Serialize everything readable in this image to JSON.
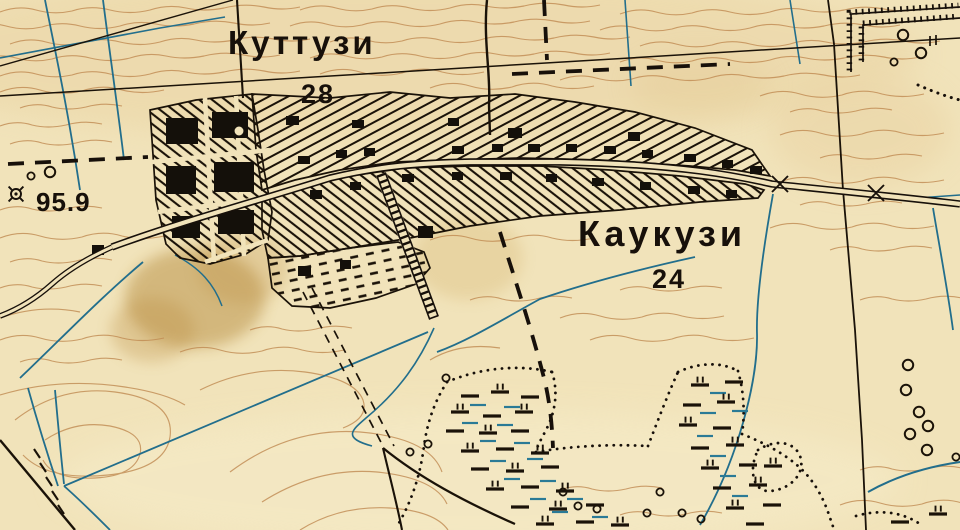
{
  "map": {
    "type": "historical-topographic-map-scan",
    "language": "Russian",
    "settlements": [
      {
        "name": "Куттузи",
        "households": "28"
      },
      {
        "name": "Каукузи",
        "households": "24"
      }
    ],
    "elevation_point": {
      "value": "95.9",
      "symbol": "geodetic-point-icon"
    },
    "colors": {
      "paper": "#f1e3ba",
      "contour": "#c08a52",
      "water": "#226e8c",
      "ink": "#1a1208",
      "stain": "#a87820"
    },
    "features": [
      "contour-lines",
      "drainage-ditches",
      "village-hatched-blocks",
      "buildings",
      "main-road",
      "field-roads",
      "administrative-boundary",
      "causeway-ladder",
      "bridges",
      "tree-circles",
      "fenced-plot",
      "peat-marsh-symbols",
      "marsh-dotted-boundary",
      "spot-elevation"
    ]
  }
}
